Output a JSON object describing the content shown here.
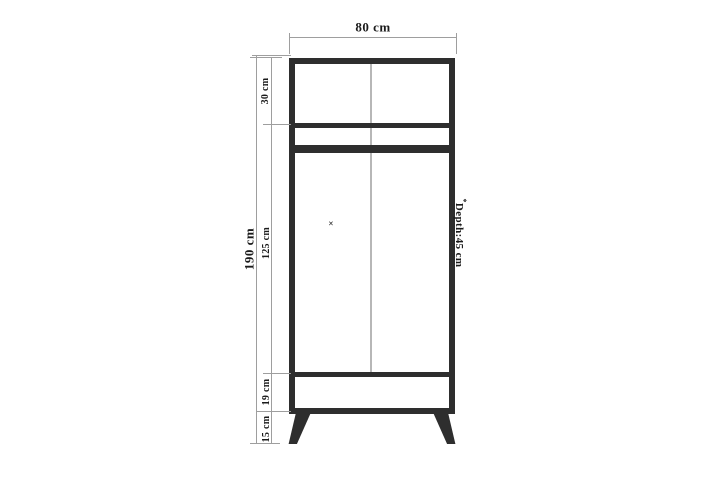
{
  "diagram": {
    "labels": {
      "width": "80 cm",
      "total_height": "190 cm",
      "section_top": "30 cm",
      "section_main": "125 cm",
      "section_drawer": "19 cm",
      "section_legs": "15 cm",
      "depth_mark": "*",
      "depth": "Depth:45 cm",
      "knob": "×"
    },
    "values": {
      "width_cm": 80,
      "total_height_cm": 190,
      "depth_cm": 45,
      "sections_cm": [
        30,
        125,
        19,
        15
      ]
    },
    "colors": {
      "outline": "#2e2e2e",
      "dimension_line": "#9e9e9e",
      "door_seam": "#b7b7b7",
      "text": "#1b1b1b",
      "background": "#ffffff"
    }
  }
}
